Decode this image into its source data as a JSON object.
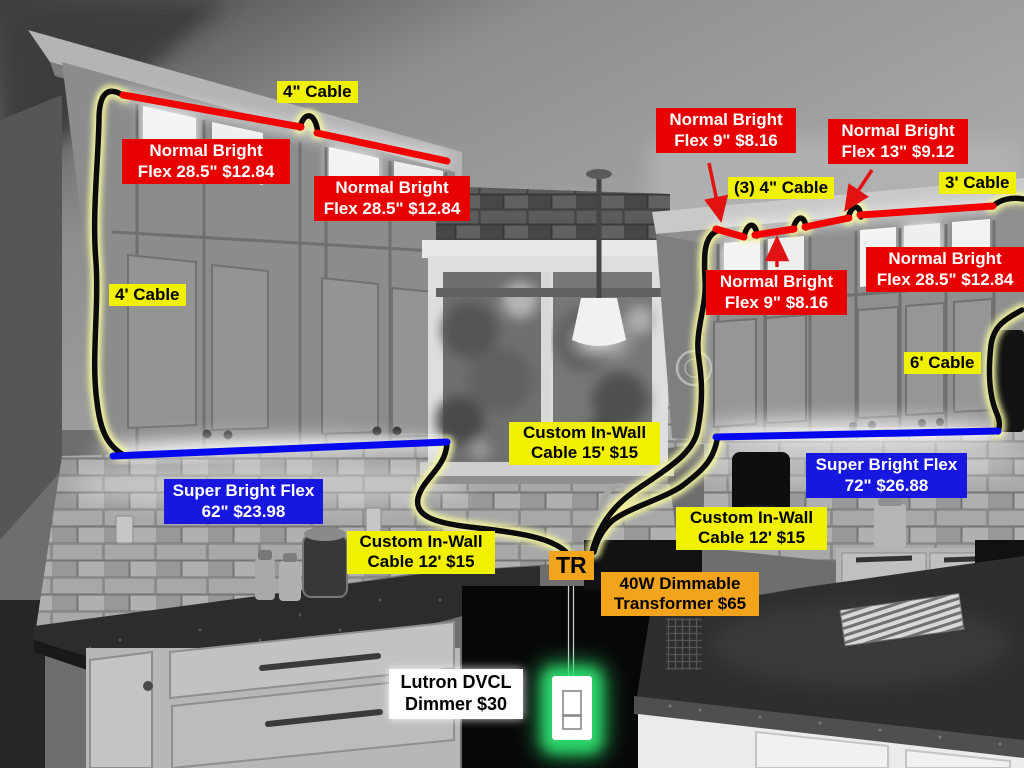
{
  "labels": {
    "cable4in": {
      "text": "4\" Cable"
    },
    "flexLeftA": {
      "line1": "Normal Bright",
      "line2": "Flex 28.5\" $12.84"
    },
    "flexLeftB": {
      "line1": "Normal Bright",
      "line2": "Flex 28.5\" $12.84"
    },
    "cable4ft": {
      "text": "4' Cable"
    },
    "flex9Top": {
      "line1": "Normal Bright",
      "line2": "Flex 9\" $8.16"
    },
    "flex13": {
      "line1": "Normal Bright",
      "line2": "Flex 13\" $9.12"
    },
    "cable3x4": {
      "text": "(3) 4\" Cable"
    },
    "cable3ft": {
      "text": "3' Cable"
    },
    "flex9Bot": {
      "line1": "Normal Bright",
      "line2": "Flex 9\" $8.16"
    },
    "flexRight": {
      "line1": "Normal Bright",
      "line2": "Flex 28.5\" $12.84"
    },
    "cable6ft": {
      "text": "6' Cable"
    },
    "superLeft": {
      "line1": "Super Bright Flex",
      "line2": "62\" $23.98"
    },
    "superRight": {
      "line1": "Super Bright Flex",
      "line2": "72\" $26.88"
    },
    "inwall15": {
      "line1": "Custom In-Wall",
      "line2": "Cable 15' $15"
    },
    "inwall12L": {
      "line1": "Custom In-Wall",
      "line2": "Cable 12' $15"
    },
    "inwall12R": {
      "line1": "Custom In-Wall",
      "line2": "Cable 12' $15"
    },
    "tr": {
      "text": "TR"
    },
    "transformer": {
      "line1": "40W Dimmable",
      "line2": "Transformer $65"
    },
    "dimmer": {
      "line1": "Lutron DVCL",
      "line2": "Dimmer $30"
    }
  },
  "colors": {
    "label_yellow": "#F0F000",
    "label_red": "#E80000",
    "label_blue": "#1717DF",
    "label_orange": "#F2A41C",
    "label_white": "#FFFFFF",
    "strip_red": "#F40000",
    "strip_blue": "#0408EE",
    "cable_black": "#0B0B0B",
    "cable_glow": "#F6F6A0",
    "dimmer_glow": "#2FE06E"
  }
}
